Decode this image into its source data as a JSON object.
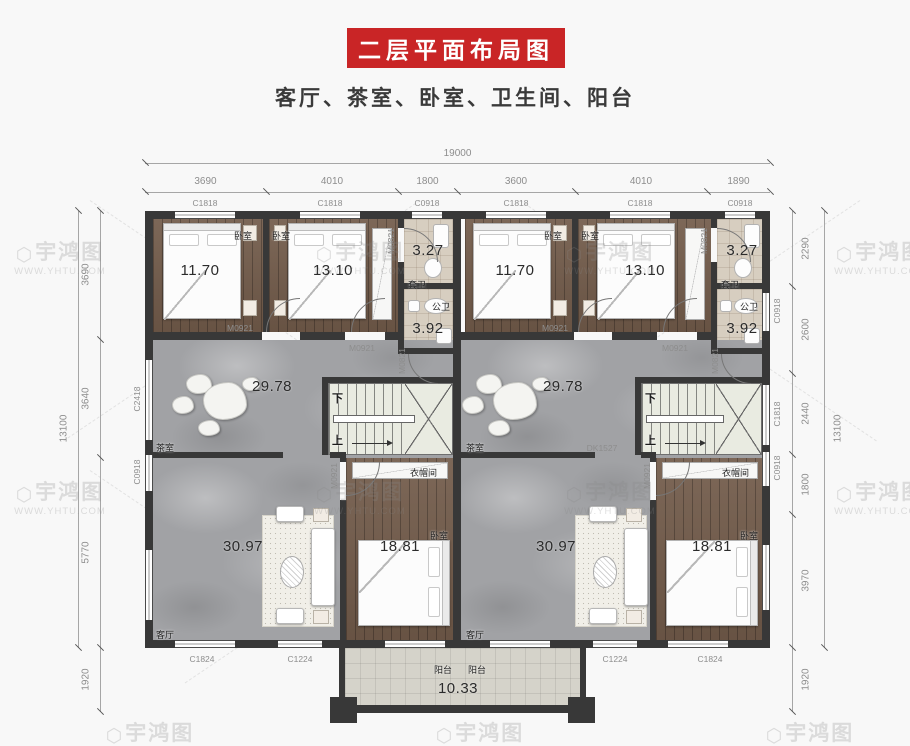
{
  "header": {
    "title": "二层平面布局图",
    "subtitle": "客厅、茶室、卧室、卫生间、阳台"
  },
  "watermark": {
    "brand": "宇鸿图",
    "url": "WWW.YHTU.COM"
  },
  "dims": {
    "top_total": "19000",
    "top": [
      "3690",
      "4010",
      "1800",
      "3600",
      "4010",
      "1890"
    ],
    "left": [
      "3690",
      "3640",
      "5770",
      "1920"
    ],
    "left_total": "13100",
    "right": [
      "2290",
      "2600",
      "2440",
      "1800",
      "3970",
      "1920"
    ],
    "right_total": "13100"
  },
  "windows": {
    "top": [
      "C1818",
      "C1818",
      "C0918",
      "C1818",
      "C1818",
      "C0918"
    ],
    "bottom": [
      "C1824",
      "C1224",
      "TLM2127",
      "TLM2127",
      "C1224",
      "C1824"
    ],
    "left": [
      "C2418",
      "C0918"
    ],
    "right": [
      "C0918",
      "C1818",
      "C0918"
    ]
  },
  "doors": {
    "bedroom": "M0921",
    "bath": "M0821",
    "opening": "DK1527"
  },
  "rooms": {
    "bedroom": "卧室",
    "tea": "茶室",
    "living": "客厅",
    "suite_bath": "套卫",
    "public_bath": "公卫",
    "cloak": "衣帽间",
    "balcony": "阳台",
    "areas": {
      "bedroom_a": "11.70",
      "bedroom_b": "13.10",
      "suite_bath": "3.27",
      "public_bath": "3.92",
      "tea": "29.78",
      "living": "30.97",
      "bedroom_c": "18.81",
      "balcony": "10.33"
    }
  },
  "stairs": {
    "down": "下",
    "up": "上"
  }
}
